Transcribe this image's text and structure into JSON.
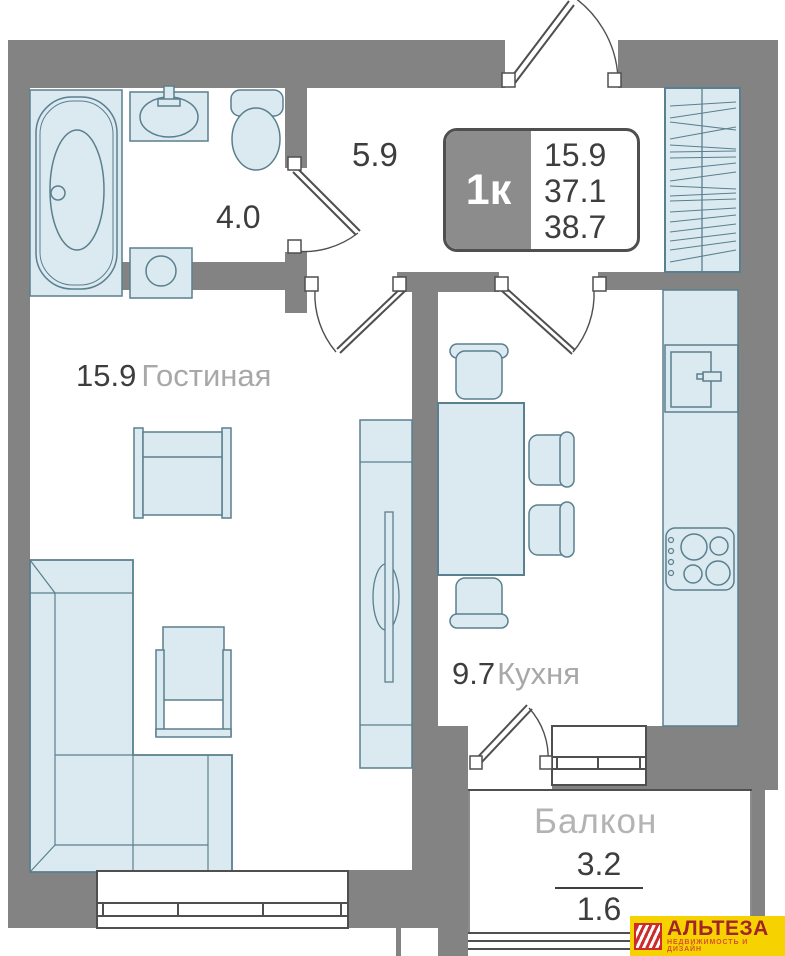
{
  "plan": {
    "unit_badge": {
      "type": "1к",
      "areas": {
        "living": "15.9",
        "apartment": "37.1",
        "total": "38.7"
      }
    },
    "rooms": {
      "hallway": {
        "area": "5.9"
      },
      "bathroom": {
        "area": "4.0"
      },
      "living": {
        "area": "15.9",
        "name": "Гостиная"
      },
      "kitchen": {
        "area": "9.7",
        "name": "Кухня"
      },
      "balcony": {
        "name": "Балкон",
        "area_total": "3.2",
        "area_counted": "1.6"
      }
    }
  },
  "logo": {
    "title": "АЛЬТЕЗА",
    "tagline": "НЕДВИЖИМОСТЬ И ДИЗАЙН"
  },
  "colors": {
    "wall": "#838383",
    "furniture_fill": "#dbeaf0",
    "furniture_stroke": "#5a7f8e",
    "plan_line": "#4f4f4f",
    "text_dark": "#3d3d3d",
    "text_gray": "#a8a8a8",
    "balcony_text": "#b3b3b3",
    "logo_bg": "#f6d300",
    "logo_title": "#a2242b",
    "logo_tagline": "#d8502e"
  }
}
